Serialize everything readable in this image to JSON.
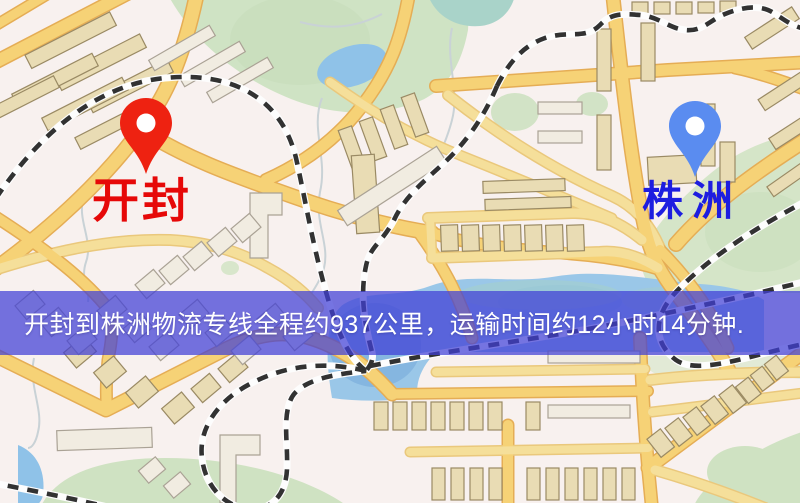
{
  "map": {
    "background_color": "#f8f1ef",
    "road_color": "#f6d276",
    "park_color": "#d5e5c8",
    "water_color": "#9ac7e8",
    "building_color": "#e9dcb4",
    "railway_color": "#323232"
  },
  "origin": {
    "label": "开封",
    "text_color": "#e60808",
    "pin_color": "#ee2211"
  },
  "destination": {
    "label": "株洲",
    "text_color": "#1d1de0",
    "pin_color": "#5a8cf0"
  },
  "banner": {
    "text": "开封到株洲物流专线全程约937公里，运输时间约12小时14分钟.",
    "background_color": "rgba(64,62,214,0.72)",
    "text_color": "#ffffff"
  }
}
